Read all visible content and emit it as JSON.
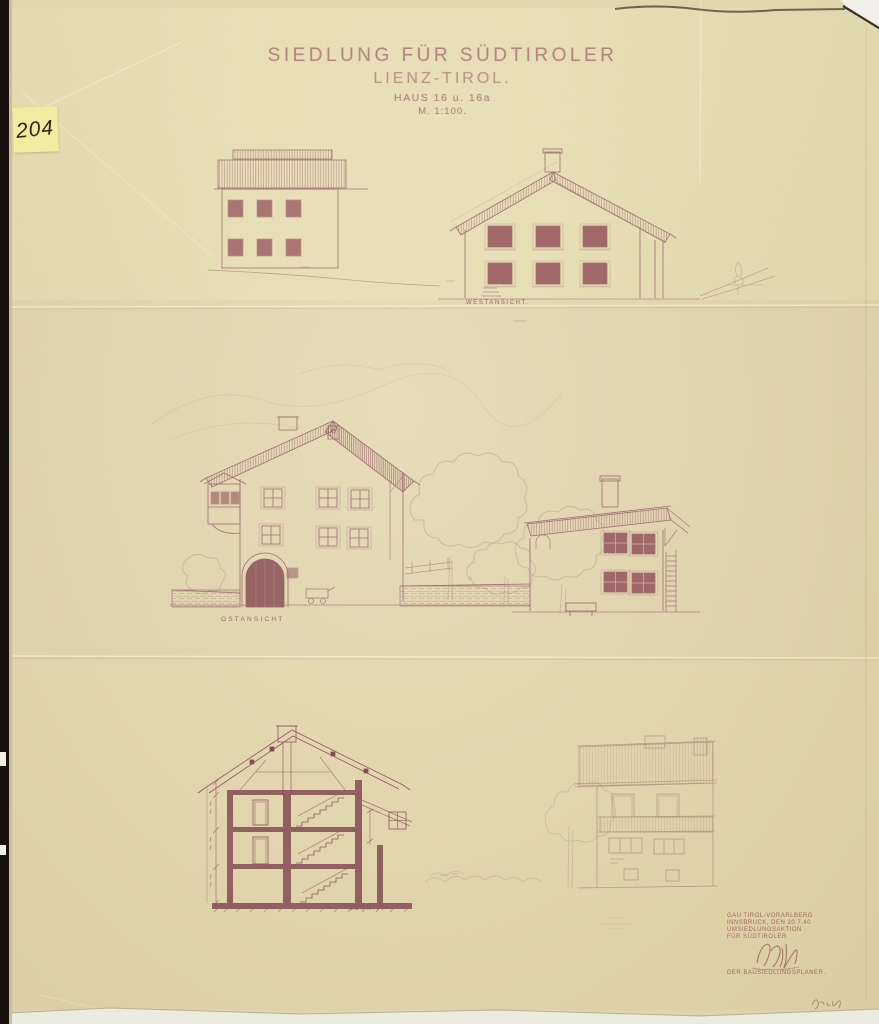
{
  "scan": {
    "archive_note": "204",
    "title": {
      "line1": "SIEDLUNG FÜR SÜDTIROLER",
      "line2": "LIENZ-TIROL.",
      "line3": "HAUS 16 u. 16a",
      "line4": "M. 1:100."
    },
    "view_labels": {
      "west": "WESTANSICHT.",
      "east": "OSTANSICHT",
      "section": "SCHNITT"
    },
    "stamp": {
      "line1": "GAU TIROL-VORARLBERG",
      "line2": "INNSBRUCK, DEN 20.7.40",
      "line3": "UMSIEDLUNGSAKTION",
      "line4": "FÜR SÜDTIROLER",
      "signer": "DER BAUSIEDLUNGSPLANER."
    },
    "colors": {
      "paper": "#e8deb3",
      "ink": "#96636a",
      "ink_dark": "#7c3f4c",
      "note": "#f2eca0"
    }
  }
}
